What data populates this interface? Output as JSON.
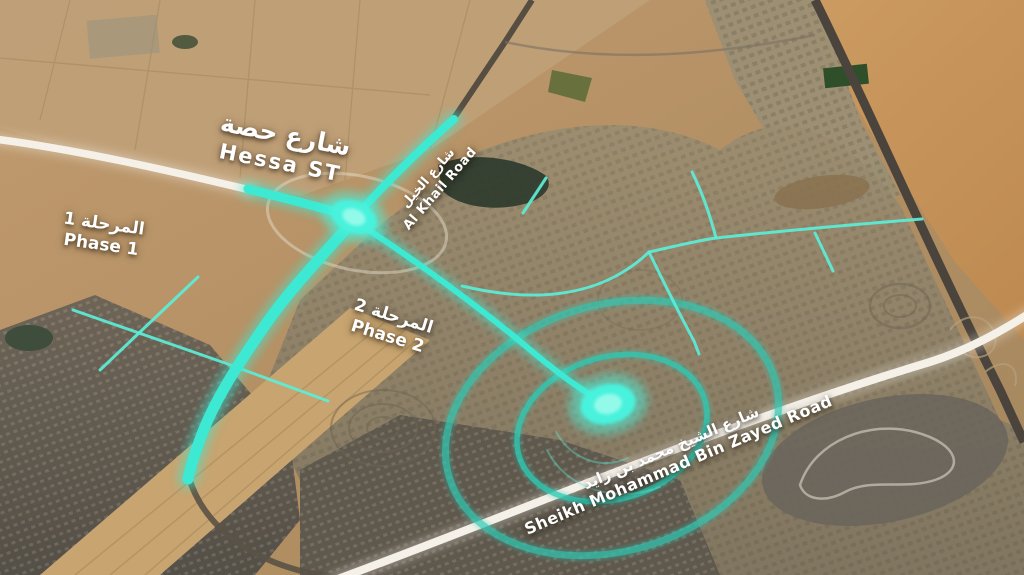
{
  "map": {
    "kind": "aerial-satellite-road-project-map",
    "labels": {
      "hessa_street": {
        "ar": "شارع حصة",
        "en": "Hessa ST"
      },
      "phase_1": {
        "ar": "المرحلة 1",
        "en": "Phase 1"
      },
      "phase_2": {
        "ar": "المرحلة 2",
        "en": "Phase 2"
      },
      "al_khail_road": {
        "ar": "شارع الخيل",
        "en": "Al Khail Road"
      },
      "sheikh_mbz_road": {
        "ar": "شارع الشيخ محمد بن زايد",
        "en": "Sheikh Mohammad Bin Zayed Road"
      }
    },
    "colors": {
      "highlight_cyan": "#3DE9D2",
      "thin_branch_cyan": "#5BEED8",
      "glow_cyan": "#49F2DC",
      "radius_circle_teal": "#2EC9B4",
      "white_road": "#F5F1E8",
      "label_text": "#FFFFFF",
      "desert_sand": "#C79A62",
      "urban_fabric": "#8F8471"
    }
  }
}
